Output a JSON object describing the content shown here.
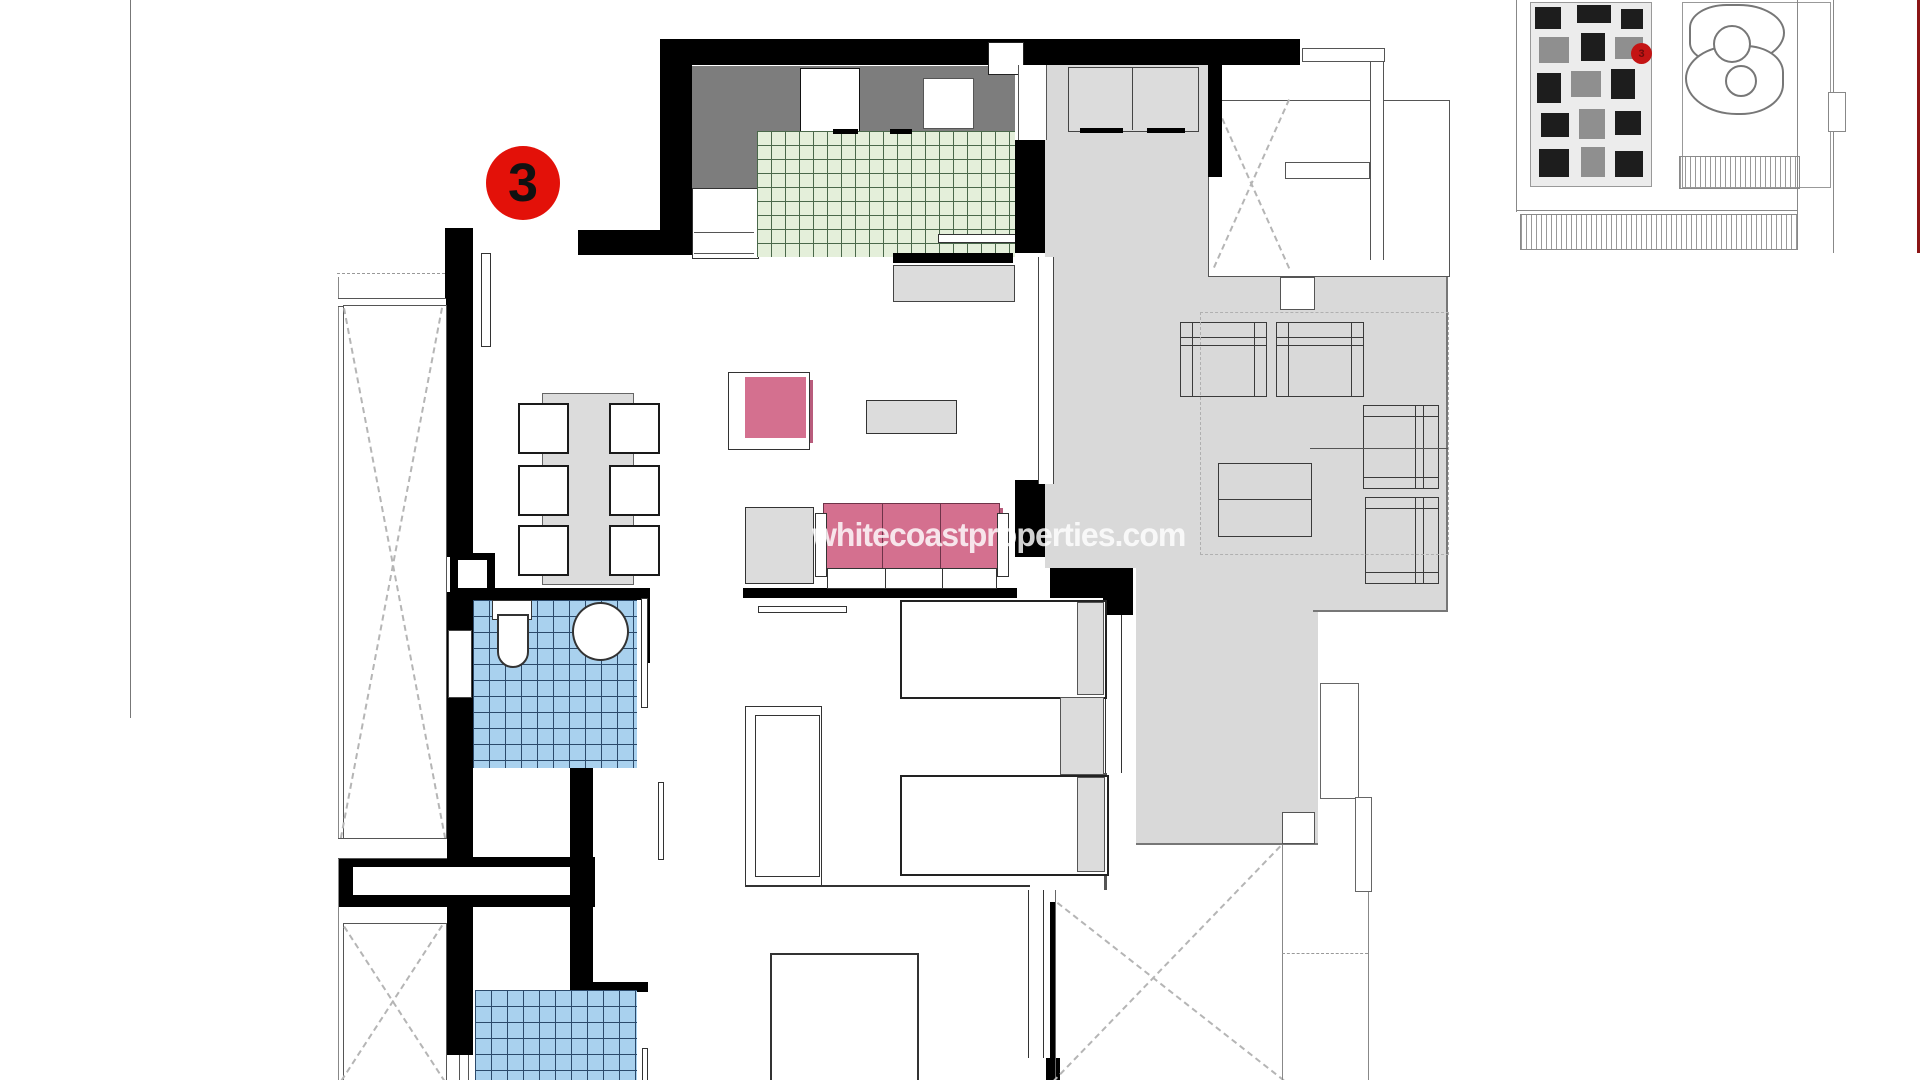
{
  "watermark": {
    "text": "whitecoastproperties.com"
  },
  "unit_badge": {
    "number": "3"
  },
  "site_plan": {
    "marker_number": "3"
  },
  "colors": {
    "wall": "#000000",
    "terrace": "#d9d9d9",
    "counter": "#7d7d7d",
    "kitchen_tile": "#e4efda",
    "kitchen_tile_line": "#4a684a",
    "bath_tile": "#a9d1ee",
    "bath_tile_line": "#2b4a6b",
    "sofa_pink": "#d4708f",
    "sofa_pink_shadow": "#b85c7c",
    "furniture_gray": "#dcdcdc",
    "badge_red": "#e31109",
    "site_marker_red": "#c41414",
    "watermark_color": "rgba(255,255,255,0.82)"
  }
}
